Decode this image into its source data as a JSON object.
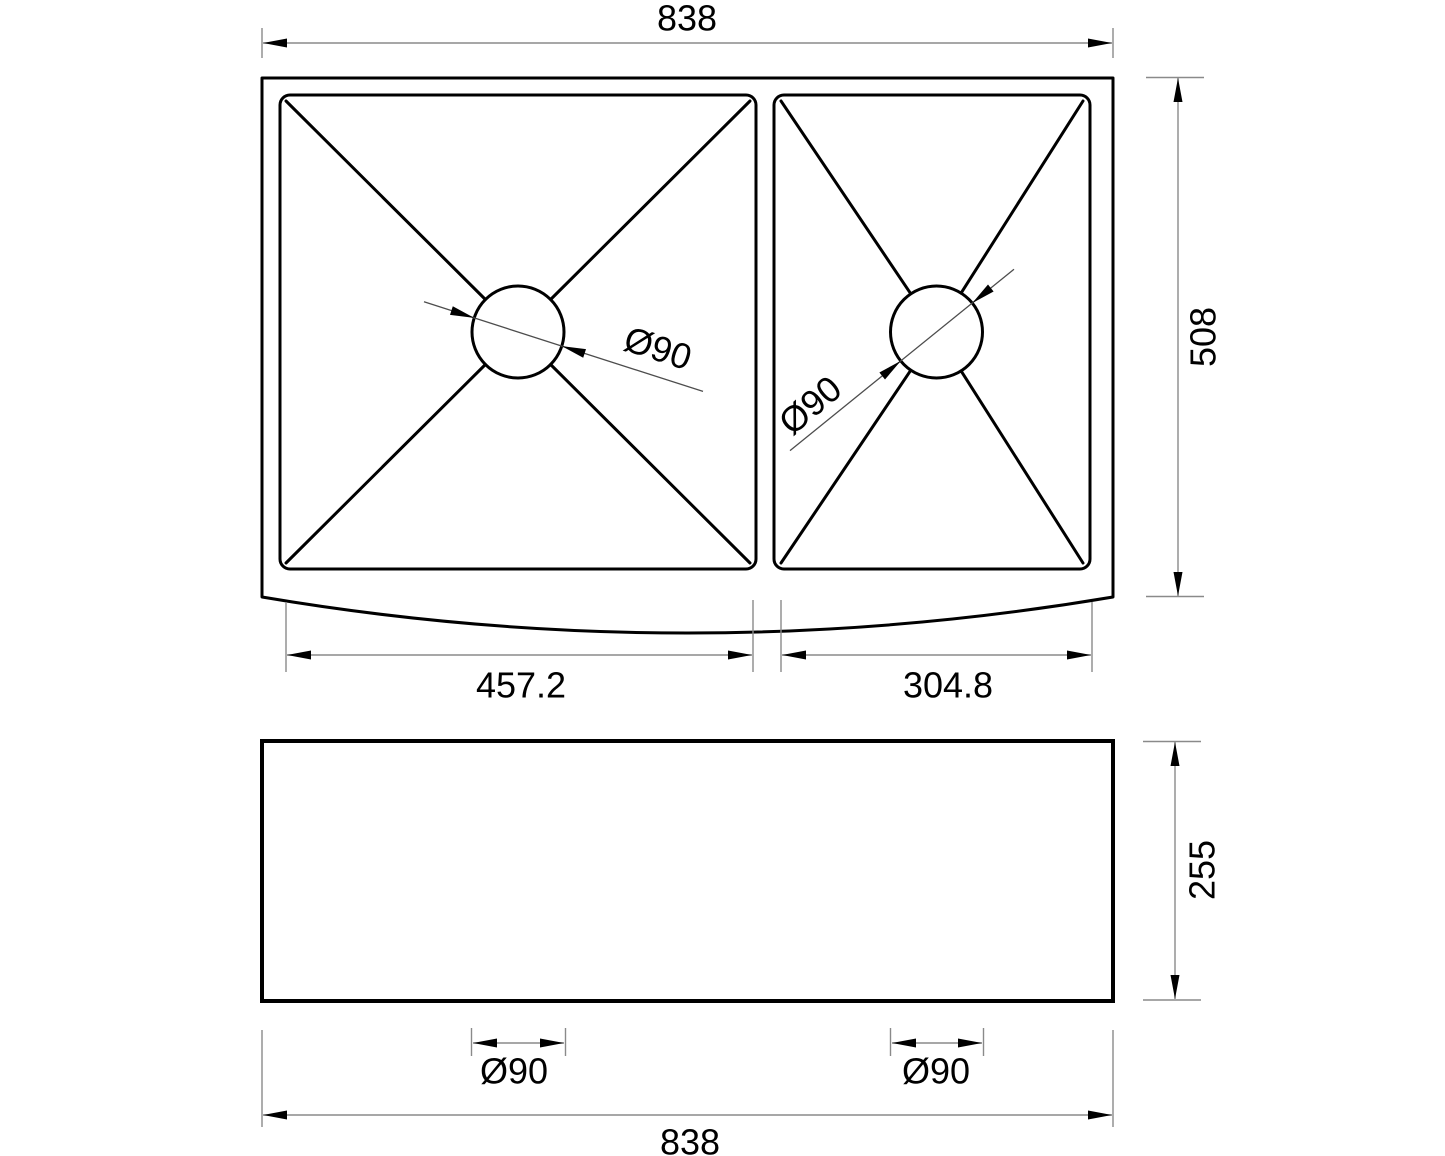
{
  "drawing": {
    "type": "technical-dimension-drawing",
    "subject": "double-bowl apron-front sink, top view and front view"
  },
  "dimensions": {
    "overall_width_top": "838",
    "overall_depth": "508",
    "left_bowl_width": "457.2",
    "right_bowl_width": "304.8",
    "left_drain_diameter": "Ø90",
    "right_drain_diameter": "Ø90",
    "front_height": "255",
    "front_left_drain_diameter": "Ø90",
    "front_right_drain_diameter": "Ø90",
    "overall_width_bottom": "838"
  },
  "colors": {
    "object_line": "#000000",
    "dimension_line": "#8a8a8a",
    "text": "#000000",
    "background": "#ffffff"
  }
}
